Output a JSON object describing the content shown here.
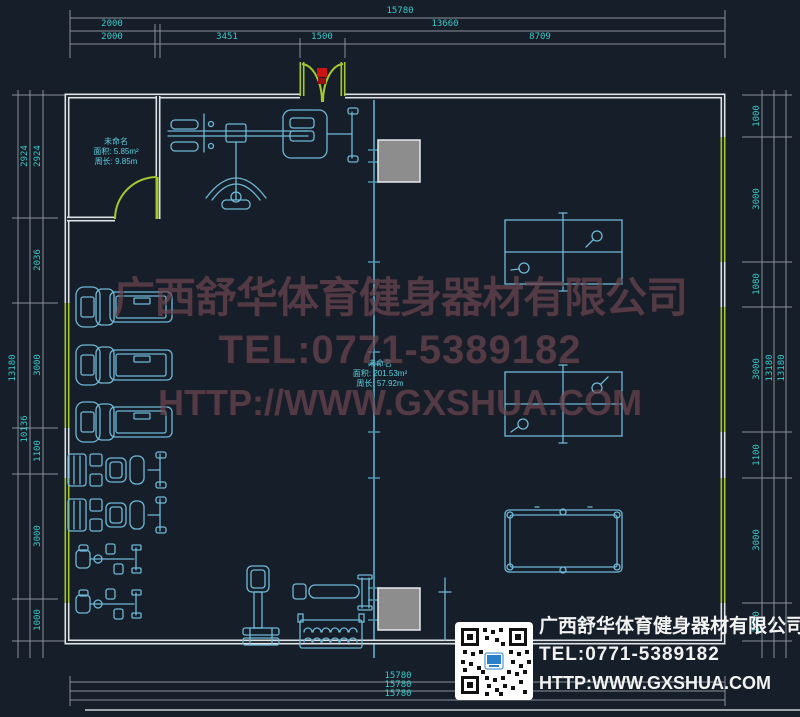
{
  "drawing": {
    "dims": {
      "top_total": "15780",
      "top_row2": [
        "2000",
        "13660"
      ],
      "top_row3": [
        "2000",
        "3451",
        "1500",
        "8709"
      ],
      "bottom": [
        "15780",
        "15780",
        "15780"
      ],
      "left_outer": "13180",
      "left_mid": [
        "2924",
        "10136"
      ],
      "left_inner": [
        "2924",
        "2036",
        "3000",
        "1100",
        "3000",
        "1000"
      ],
      "right_inner": [
        "1000",
        "3000",
        "1080",
        "3000",
        "1100",
        "3000",
        "1000"
      ],
      "right_mid": "13180",
      "right_outer": "13180"
    },
    "rooms": {
      "small": {
        "name": "未命名",
        "area": "面积: 5.85m²",
        "perimeter": "周长: 9.85m"
      },
      "main": {
        "name": "未命名",
        "area": "面积: 201.53m²",
        "perimeter": "周长: 57.92m"
      }
    }
  },
  "watermark": {
    "company": "广西舒华体育健身器材有限公司",
    "tel": "TEL:0771-5389182",
    "url": "HTTP://WWW.GXSHUA.COM"
  },
  "infobox": {
    "company": "广西舒华体育健身器材有限公司",
    "tel": "TEL:0771-5389182",
    "url": "HTTP:WWW.GXSHUA.COM"
  },
  "colors": {
    "background": "#161e29",
    "wall": "#dfe3e8",
    "highlight_wall": "#a3c832",
    "equipment": "#6fb8d6",
    "dimension_text": "#3cc9c9",
    "dimension_line": "#8a9099",
    "centerline": "#4f93ad",
    "column_fill": "#8d8d8d",
    "door_sensor": "#cc1414",
    "watermark": "#96646e",
    "info_text": "#f2f2f2"
  }
}
